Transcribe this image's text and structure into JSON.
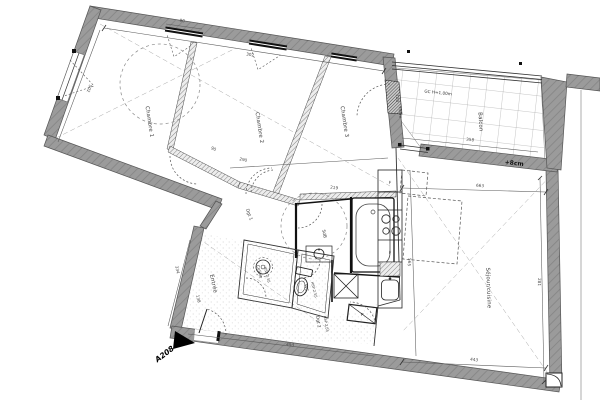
{
  "plan": {
    "unit": "A208",
    "rooms": [
      {
        "label": "Chambre 1"
      },
      {
        "label": "Chambre 2"
      },
      {
        "label": "Chambre 3"
      },
      {
        "label": "Balcon"
      },
      {
        "label": "Séjour/cuisine"
      },
      {
        "label": "Entrée"
      },
      {
        "label": "Cellier",
        "height": "HSP 2.55"
      },
      {
        "label": "WC",
        "height": "HSP 2.55"
      },
      {
        "label": "SdB"
      },
      {
        "label": "Dgt 1"
      },
      {
        "label": "Dgt 2",
        "height": "HSP 2.55"
      }
    ],
    "annotations": {
      "guardrail": "GC H=1.00m",
      "balcony_level": "+8cm",
      "door_level": "+6cm",
      "closet": "P",
      "fridge": "F",
      "oven": "F"
    },
    "dimensions": [
      {
        "value": "302"
      },
      {
        "value": "290"
      },
      {
        "value": "219"
      },
      {
        "value": "90"
      },
      {
        "value": "358"
      },
      {
        "value": "663"
      },
      {
        "value": "443"
      },
      {
        "value": "281"
      },
      {
        "value": "565"
      },
      {
        "value": "493"
      },
      {
        "value": "138"
      },
      {
        "value": "334"
      },
      {
        "value": "502"
      },
      {
        "value": "120"
      },
      {
        "value": "90"
      }
    ]
  },
  "colors": {
    "wall_gray": "#9b9b9b",
    "wall_edge": "#555555",
    "line": "#3a3a3a",
    "fixture_black": "#111111",
    "background": "#ffffff"
  }
}
